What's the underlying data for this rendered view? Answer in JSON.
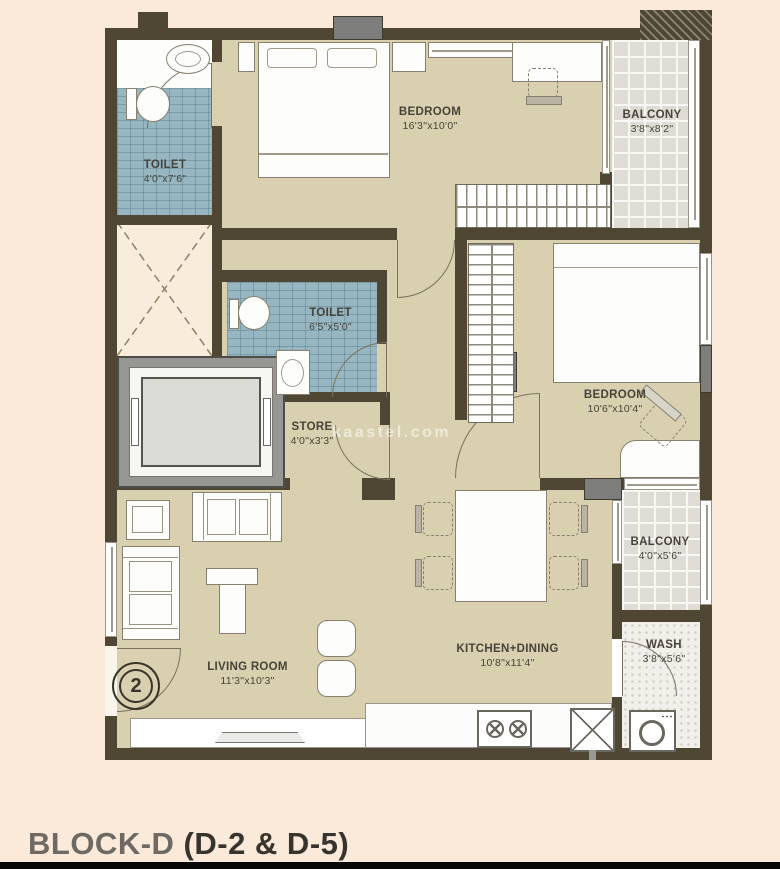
{
  "title": {
    "block": "BLOCK-D",
    "units": "(D-2 & D-5)"
  },
  "unit_badge": "2",
  "watermark": "kaastel.com",
  "rooms": {
    "toilet1": {
      "label": "TOILET",
      "dims": "4'0\"x7'6\""
    },
    "bedroom1": {
      "label": "BEDROOM",
      "dims": "16'3\"x10'0\""
    },
    "balcony1": {
      "label": "BALCONY",
      "dims": "3'8\"x8'2\""
    },
    "toilet2": {
      "label": "TOILET",
      "dims": "6'5\"x5'0\""
    },
    "store": {
      "label": "STORE",
      "dims": "4'0\"x3'3\""
    },
    "bedroom2": {
      "label": "BEDROOM",
      "dims": "10'6\"x10'4\""
    },
    "balcony2": {
      "label": "BALCONY",
      "dims": "4'0\"x5'6\""
    },
    "wash": {
      "label": "WASH",
      "dims": "3'8\"x5'6\""
    },
    "kitchen": {
      "label": "KITCHEN+DINING",
      "dims": "10'8\"x11'4\""
    },
    "living": {
      "label": "LIVING ROOM",
      "dims": "11'3\"x10'3\""
    }
  },
  "colors": {
    "wall": "#4f4733",
    "floor": "#d8d0ae",
    "toilet_tile": "#96b6c2",
    "balcony_tile": "#dedcd4",
    "background": "#fbe9d9"
  }
}
